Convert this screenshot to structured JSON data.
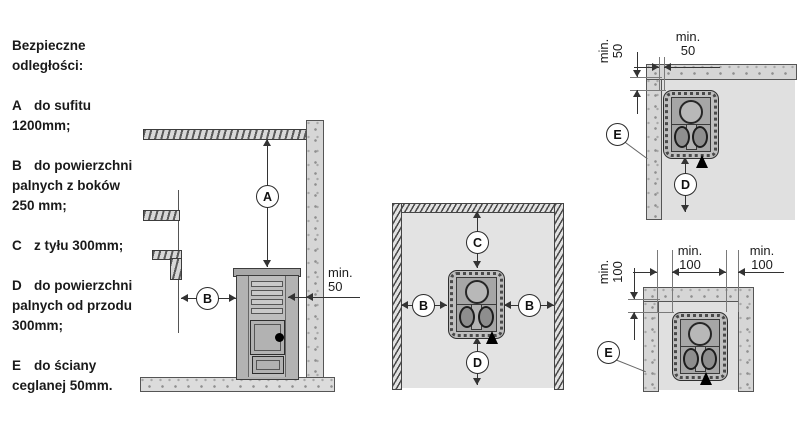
{
  "legend": {
    "title": "Bezpieczne odległości:",
    "items": [
      {
        "letter": "A",
        "text": "do sufitu 1200mm;"
      },
      {
        "letter": "B",
        "text": "do powierzchni palnych z boków 250 mm;"
      },
      {
        "letter": "C",
        "text": "z tyłu 300mm;"
      },
      {
        "letter": "D",
        "text": "do powierzchni palnych od przodu 300mm;"
      },
      {
        "letter": "E",
        "text": "do ściany ceglanej 50mm."
      }
    ]
  },
  "diagrams": {
    "side_view": {
      "callout_a": "A",
      "callout_b": "B",
      "dim_wall": {
        "l1": "min.",
        "l2": "50"
      }
    },
    "top_view": {
      "callout_c": "C",
      "callout_b_left": "B",
      "callout_b_right": "B",
      "callout_d": "D"
    },
    "corner_view": {
      "callout_e": "E",
      "callout_d": "D",
      "dim_top": {
        "l1": "min.",
        "l2": "50"
      },
      "dim_side": {
        "l1": "min.",
        "l2": "50"
      }
    },
    "niche_view": {
      "callout_e": "E",
      "dim_left": {
        "l1": "min.",
        "l2": "100"
      },
      "dim_right": {
        "l1": "min.",
        "l2": "100"
      },
      "dim_side": {
        "l1": "min.",
        "l2": "100"
      }
    }
  },
  "colors": {
    "line": "#333333",
    "text": "#1a1a1a",
    "floor": "#e3e3e3",
    "wall": "#d6d6d6",
    "stove": "#bfbfbf"
  }
}
